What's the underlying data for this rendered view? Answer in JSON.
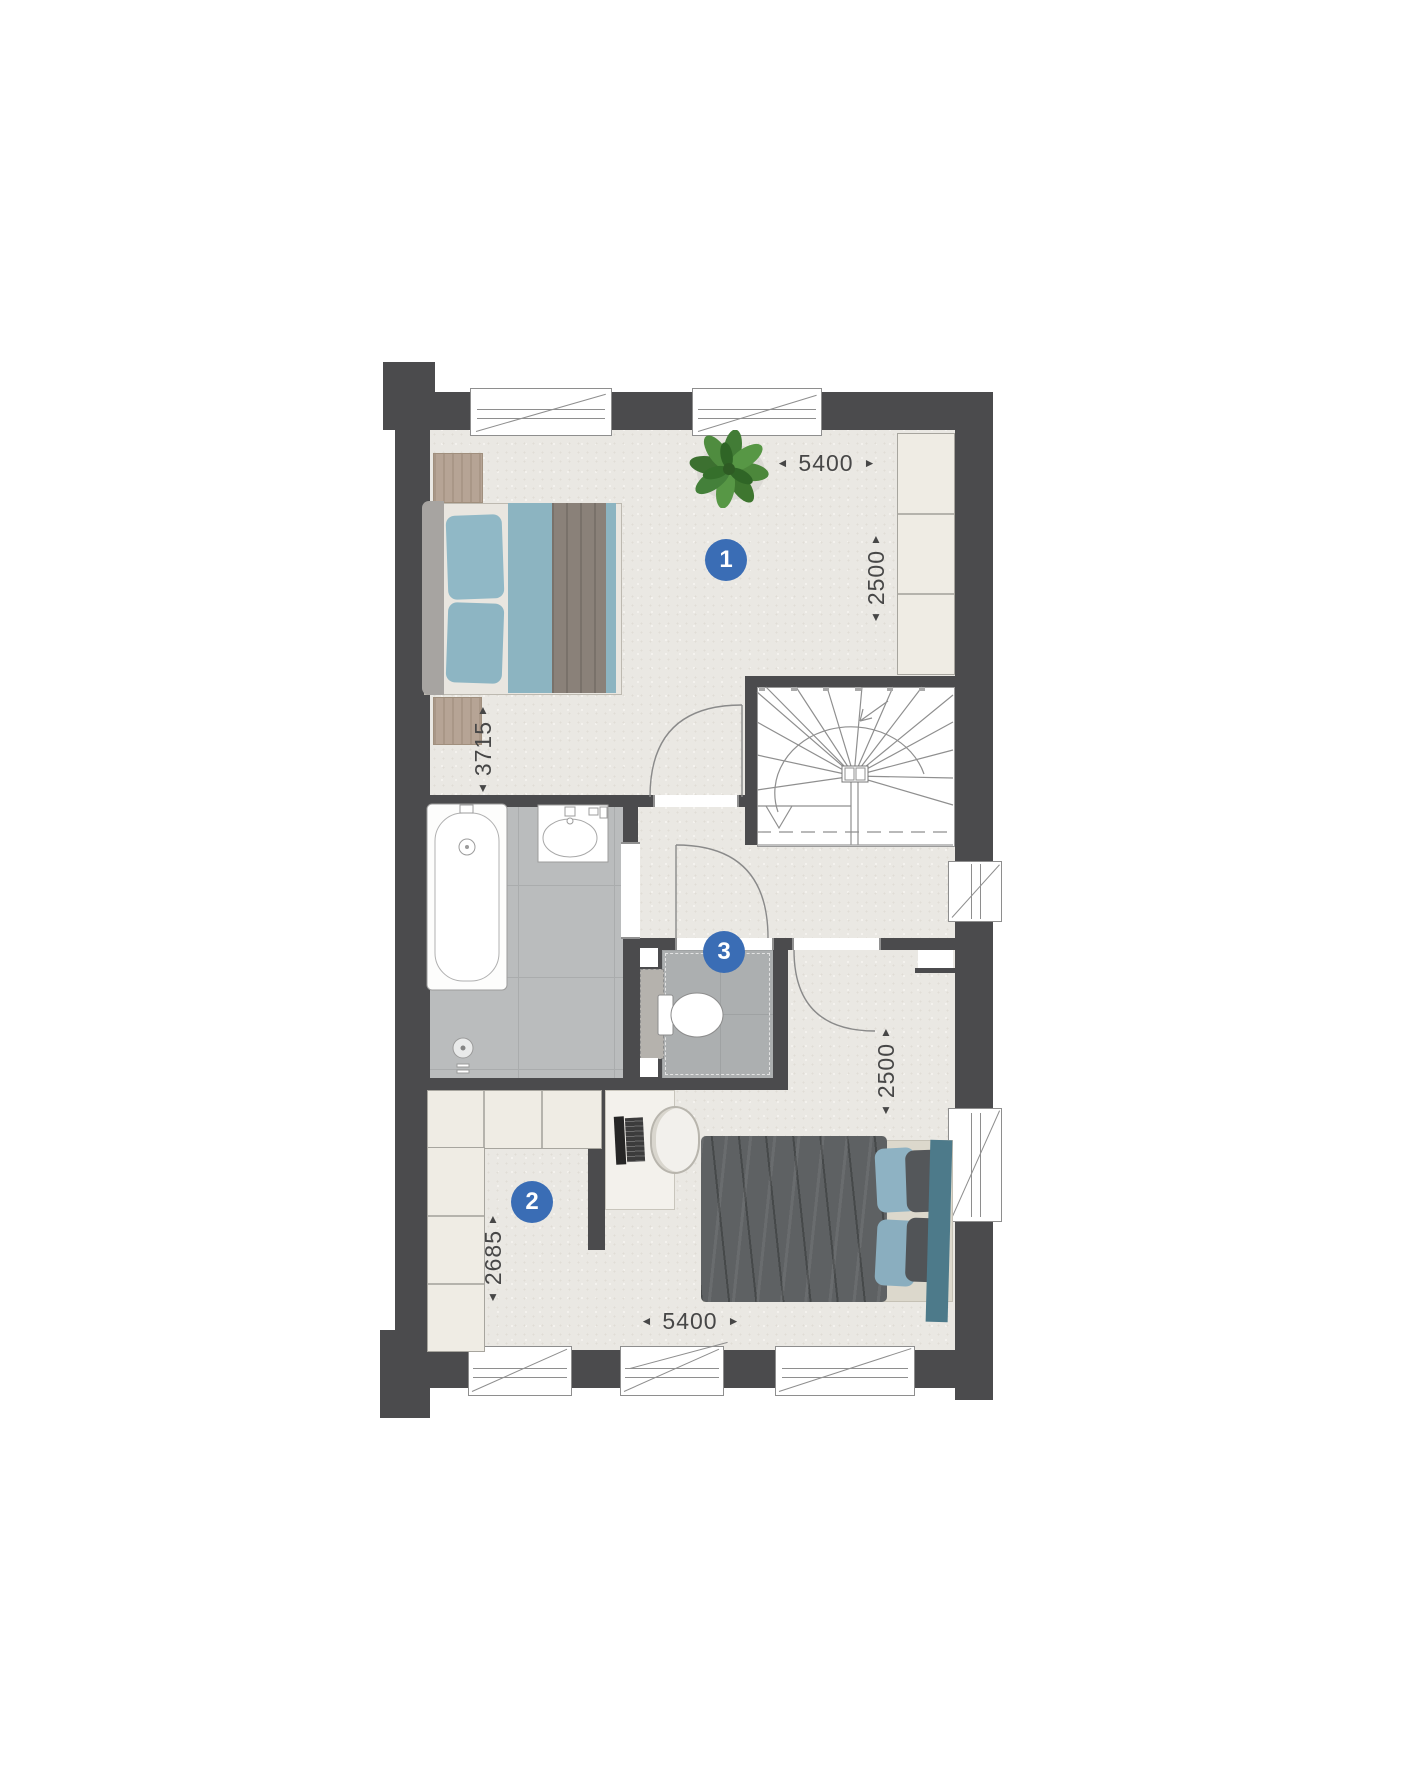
{
  "floorplan": {
    "badges": {
      "bedroom1": "1",
      "bedroom2": "2",
      "toilet": "3"
    },
    "dimensions": {
      "top_width": "5400",
      "upper_right_depth": "2500",
      "bedroom1_depth": "3715",
      "bedroom2_depth": "2685",
      "lower_right_depth": "2500",
      "bottom_width": "5400"
    },
    "arrows": {
      "left": "◄",
      "right": "►",
      "up": "▲",
      "down": "▼"
    },
    "colors": {
      "wall": "#4b4b4d",
      "badge": "#3a6db5",
      "floor": "#eae8e3",
      "tile": "#babcbd",
      "accent_teal": "#8cb4c1",
      "fabric_dark": "#5e6163",
      "wood": "#b6a495",
      "cabinet": "#efece4"
    }
  }
}
